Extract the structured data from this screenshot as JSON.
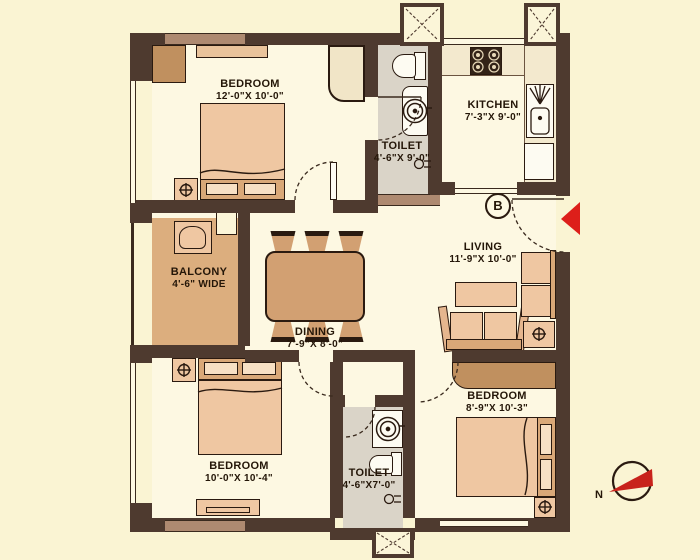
{
  "plan_title": "2BHK-style apartment floor plan",
  "rooms": {
    "bedroom1": {
      "name": "BEDROOM",
      "dims": "12'-0\"X 10'-0\""
    },
    "toilet1": {
      "name": "TOILET",
      "dims": "4'-6\"X 9'-0\""
    },
    "kitchen": {
      "name": "KITCHEN",
      "dims": "7'-3\"X 9'-0\""
    },
    "living": {
      "name": "LIVING",
      "dims": "11'-9\"X 10'-0\""
    },
    "balcony": {
      "name": "BALCONY",
      "dims": "4'-6\" WIDE"
    },
    "dining": {
      "name": "DINING",
      "dims": "7'-9\"X 8'-0\""
    },
    "bedroom2": {
      "name": "BEDROOM",
      "dims": "10'-0\"X 10'-4\""
    },
    "toilet2": {
      "name": "TOILET",
      "dims": "4'-6\"X7'-0\""
    },
    "bedroom3": {
      "name": "BEDROOM",
      "dims": "8'-9\"X 10'-3\""
    }
  },
  "markers": {
    "entry_block": "B",
    "compass_north": "N"
  },
  "colors": {
    "background": "#FAF4D3",
    "room_floor": "#FDF8E2",
    "wall": "#4E3A2F",
    "balcony_floor": "#DCAE7E",
    "toilet_floor": "#DAD4C8",
    "furniture_peach": "#EFC7A2",
    "wood": "#C0905F",
    "accent_red": "#DD1F1A"
  },
  "icons": {
    "lamp_glyph": "circled-cross table-lamp symbol",
    "compass": "red needle pointing to N (left)",
    "entrance_arrow": "red triangle at main door"
  }
}
